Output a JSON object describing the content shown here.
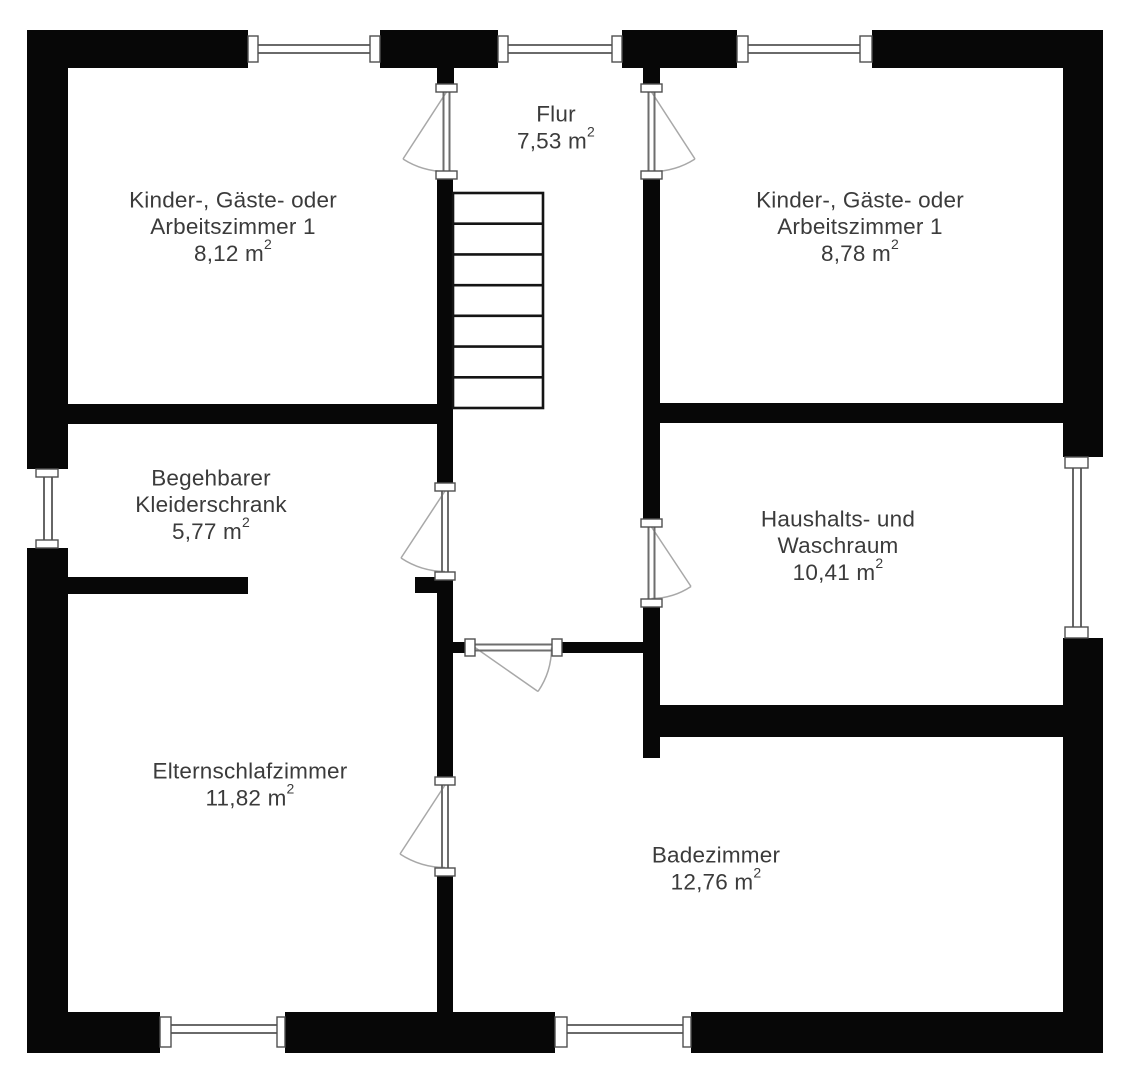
{
  "document": {
    "kind": "floor-plan",
    "language": "de",
    "background": "#ffffff"
  },
  "colors": {
    "wall": "#070707",
    "window_fill": "#ffffff",
    "frame_stroke": "#4f4f4f",
    "glass_stroke": "#555555",
    "panel_stroke": "#6e6e6e",
    "swing_stroke": "#a8a8a8",
    "stair_stroke": "#141414",
    "text": "#3b3b3b"
  },
  "canvas": {
    "width": 1131,
    "height": 1080
  },
  "typography": {
    "font_size": 22.5,
    "sup_font_size": 14,
    "sup_rise": -9,
    "line_height": 26.5
  },
  "rooms": [
    {
      "id": "kinder-gaeste-arbeitszimmer-links",
      "lines": [
        "Kinder-, Gäste- oder",
        "Arbeitszimmer 1"
      ],
      "area": "8,12 m²",
      "cx": 233,
      "cy": 200
    },
    {
      "id": "flur",
      "lines": [
        "Flur"
      ],
      "area": "7,53 m²",
      "cx": 556,
      "cy": 114
    },
    {
      "id": "kinder-gaeste-arbeitszimmer-rechts",
      "lines": [
        "Kinder-, Gäste- oder",
        "Arbeitszimmer 1"
      ],
      "area": "8,78 m²",
      "cx": 860,
      "cy": 200
    },
    {
      "id": "begehbarer-kleiderschrank",
      "lines": [
        "Begehbarer",
        "Kleiderschrank"
      ],
      "area": "5,77 m²",
      "cx": 211,
      "cy": 478
    },
    {
      "id": "haushalts-und-waschraum",
      "lines": [
        "Haushalts- und",
        "Waschraum"
      ],
      "area": "10,41 m²",
      "cx": 838,
      "cy": 519
    },
    {
      "id": "elternschlafzimmer",
      "lines": [
        "Elternschlafzimmer"
      ],
      "area": "11,82 m²",
      "cx": 250,
      "cy": 771
    },
    {
      "id": "badezimmer",
      "lines": [
        "Badezimmer"
      ],
      "area": "12,76 m²",
      "cx": 716,
      "cy": 855
    }
  ],
  "structure": {
    "walls": [
      {
        "id": "outer-wall-top-1",
        "r": [
          27,
          30,
          221,
          38
        ]
      },
      {
        "id": "outer-wall-top-2",
        "r": [
          380,
          30,
          118,
          38
        ]
      },
      {
        "id": "outer-wall-top-3",
        "r": [
          622,
          30,
          115,
          38
        ]
      },
      {
        "id": "outer-wall-top-4",
        "r": [
          872,
          30,
          231,
          38
        ]
      },
      {
        "id": "outer-wall-left-1",
        "r": [
          27,
          30,
          41,
          439
        ]
      },
      {
        "id": "outer-wall-left-2",
        "r": [
          27,
          548,
          41,
          505
        ]
      },
      {
        "id": "outer-wall-right-1",
        "r": [
          1063,
          30,
          40,
          427
        ]
      },
      {
        "id": "outer-wall-right-2",
        "r": [
          1063,
          638,
          40,
          415
        ]
      },
      {
        "id": "outer-wall-bottom-1",
        "r": [
          27,
          1012,
          133,
          41
        ]
      },
      {
        "id": "outer-wall-bottom-2",
        "r": [
          285,
          1012,
          270,
          41
        ]
      },
      {
        "id": "outer-wall-bottom-3",
        "r": [
          691,
          1012,
          412,
          41
        ]
      },
      {
        "id": "flur-door-stub-left",
        "r": [
          437,
          68,
          17,
          16
        ]
      },
      {
        "id": "flur-door-stub-right",
        "r": [
          643,
          68,
          17,
          16
        ]
      },
      {
        "id": "stair-wall-left-upper",
        "r": [
          437,
          179,
          16,
          304
        ]
      },
      {
        "id": "stair-wall-left-mid",
        "r": [
          437,
          580,
          16,
          197
        ]
      },
      {
        "id": "stair-wall-left-lower",
        "r": [
          437,
          876,
          16,
          136
        ]
      },
      {
        "id": "stair-wall-right-upper",
        "r": [
          643,
          179,
          17,
          341
        ]
      },
      {
        "id": "stair-wall-right-lower",
        "r": [
          643,
          607,
          17,
          151
        ]
      },
      {
        "id": "divider-left-rooms",
        "r": [
          62,
          404,
          391,
          20
        ]
      },
      {
        "id": "divider-right-rooms",
        "r": [
          655,
          403,
          408,
          20
        ]
      },
      {
        "id": "kleiderschrank-wall",
        "r": [
          62,
          577,
          186,
          17
        ]
      },
      {
        "id": "kleiderschrank-stub",
        "r": [
          415,
          577,
          22,
          16
        ]
      },
      {
        "id": "bath-door-stub",
        "r": [
          453,
          642,
          12,
          11
        ]
      },
      {
        "id": "bath-corridor-wall",
        "r": [
          562,
          642,
          85,
          11
        ]
      },
      {
        "id": "haushalt-bath-wall",
        "r": [
          655,
          705,
          408,
          32
        ]
      }
    ],
    "windows": [
      {
        "id": "window-top-left",
        "frames": [
          [
            248,
            36,
            10,
            26
          ],
          [
            370,
            36,
            10,
            26
          ]
        ],
        "glass": [
          [
            258,
            45,
            370,
            45
          ],
          [
            258,
            53,
            370,
            53
          ]
        ]
      },
      {
        "id": "window-top-center",
        "frames": [
          [
            498,
            36,
            10,
            26
          ],
          [
            612,
            36,
            10,
            26
          ]
        ],
        "glass": [
          [
            508,
            45,
            612,
            45
          ],
          [
            508,
            53,
            612,
            53
          ]
        ]
      },
      {
        "id": "window-top-right",
        "frames": [
          [
            737,
            36,
            11,
            26
          ],
          [
            860,
            36,
            12,
            26
          ]
        ],
        "glass": [
          [
            748,
            45,
            860,
            45
          ],
          [
            748,
            53,
            860,
            53
          ]
        ]
      },
      {
        "id": "window-left",
        "frames": [
          [
            36,
            469,
            22,
            8
          ],
          [
            36,
            540,
            22,
            8
          ]
        ],
        "glass": [
          [
            44,
            477,
            44,
            540
          ],
          [
            52,
            477,
            52,
            540
          ]
        ]
      },
      {
        "id": "window-right",
        "frames": [
          [
            1065,
            457,
            23,
            11
          ],
          [
            1065,
            627,
            23,
            11
          ]
        ],
        "glass": [
          [
            1073,
            468,
            1073,
            627
          ],
          [
            1081,
            468,
            1081,
            627
          ]
        ]
      },
      {
        "id": "window-bottom-left",
        "frames": [
          [
            160,
            1017,
            11,
            30
          ],
          [
            277,
            1017,
            8,
            30
          ]
        ],
        "glass": [
          [
            171,
            1025,
            277,
            1025
          ],
          [
            171,
            1033,
            277,
            1033
          ]
        ]
      },
      {
        "id": "window-bottom-center",
        "frames": [
          [
            555,
            1017,
            12,
            30
          ],
          [
            683,
            1017,
            8,
            30
          ]
        ],
        "glass": [
          [
            567,
            1025,
            683,
            1025
          ],
          [
            567,
            1033,
            683,
            1033
          ]
        ]
      }
    ],
    "doors": [
      {
        "id": "door-flur-left-room",
        "hinge": [
          446.5,
          92
        ],
        "leaf_tip": [
          403,
          159
        ],
        "radius": 79.5,
        "arc_end": [
          446.5,
          171.5
        ],
        "sweep": 0,
        "panel": [
          [
            443.5,
            92,
            443.5,
            171
          ],
          [
            449.5,
            92,
            449.5,
            171
          ]
        ],
        "jambs": [
          [
            436,
            84,
            21,
            8
          ],
          [
            436,
            171,
            21,
            8
          ]
        ]
      },
      {
        "id": "door-flur-right-room",
        "hinge": [
          651.5,
          92
        ],
        "leaf_tip": [
          695,
          159
        ],
        "radius": 79.5,
        "arc_end": [
          651.5,
          171.5
        ],
        "sweep": 1,
        "panel": [
          [
            648.5,
            92,
            648.5,
            171
          ],
          [
            654.5,
            92,
            654.5,
            171
          ]
        ],
        "jambs": [
          [
            641,
            84,
            21,
            8
          ],
          [
            641,
            171,
            21,
            8
          ]
        ]
      },
      {
        "id": "door-kleiderschrank",
        "hinge": [
          445,
          491
        ],
        "leaf_tip": [
          401,
          558
        ],
        "radius": 81,
        "arc_end": [
          445,
          571.5
        ],
        "sweep": 0,
        "panel": [
          [
            442,
            491,
            442,
            572
          ],
          [
            448,
            491,
            448,
            572
          ]
        ],
        "jambs": [
          [
            435,
            483,
            20,
            8
          ],
          [
            435,
            572,
            20,
            8
          ]
        ]
      },
      {
        "id": "door-haushaltsraum",
        "hinge": [
          651.5,
          527
        ],
        "leaf_tip": [
          691,
          586.5
        ],
        "radius": 72,
        "arc_end": [
          651.5,
          598.5
        ],
        "sweep": 1,
        "panel": [
          [
            648.5,
            527,
            648.5,
            599
          ],
          [
            654.5,
            527,
            654.5,
            599
          ]
        ],
        "jambs": [
          [
            641,
            519,
            21,
            8
          ],
          [
            641,
            599,
            21,
            8
          ]
        ]
      },
      {
        "id": "door-badezimmer-flur",
        "hinge": [
          475,
          647.5
        ],
        "leaf_tip": [
          538,
          691.5
        ],
        "radius": 77,
        "arc_end": [
          551.5,
          647.5
        ],
        "sweep": 0,
        "panel": [
          [
            475,
            644.5,
            552,
            644.5
          ],
          [
            475,
            650.5,
            552,
            650.5
          ]
        ],
        "jambs": [
          [
            465,
            639,
            10,
            17
          ],
          [
            552,
            639,
            10,
            17
          ]
        ]
      },
      {
        "id": "door-badezimmer-eltern",
        "hinge": [
          445,
          785
        ],
        "leaf_tip": [
          400,
          854
        ],
        "radius": 83,
        "arc_end": [
          445,
          867.5
        ],
        "sweep": 0,
        "panel": [
          [
            442,
            785,
            442,
            868
          ],
          [
            448,
            785,
            448,
            868
          ]
        ],
        "jambs": [
          [
            435,
            777,
            20,
            8
          ],
          [
            435,
            868,
            20,
            8
          ]
        ]
      }
    ],
    "stairs": {
      "id": "staircase",
      "x": 453,
      "y": 193,
      "w": 90,
      "h": 215,
      "treads": 7
    }
  }
}
